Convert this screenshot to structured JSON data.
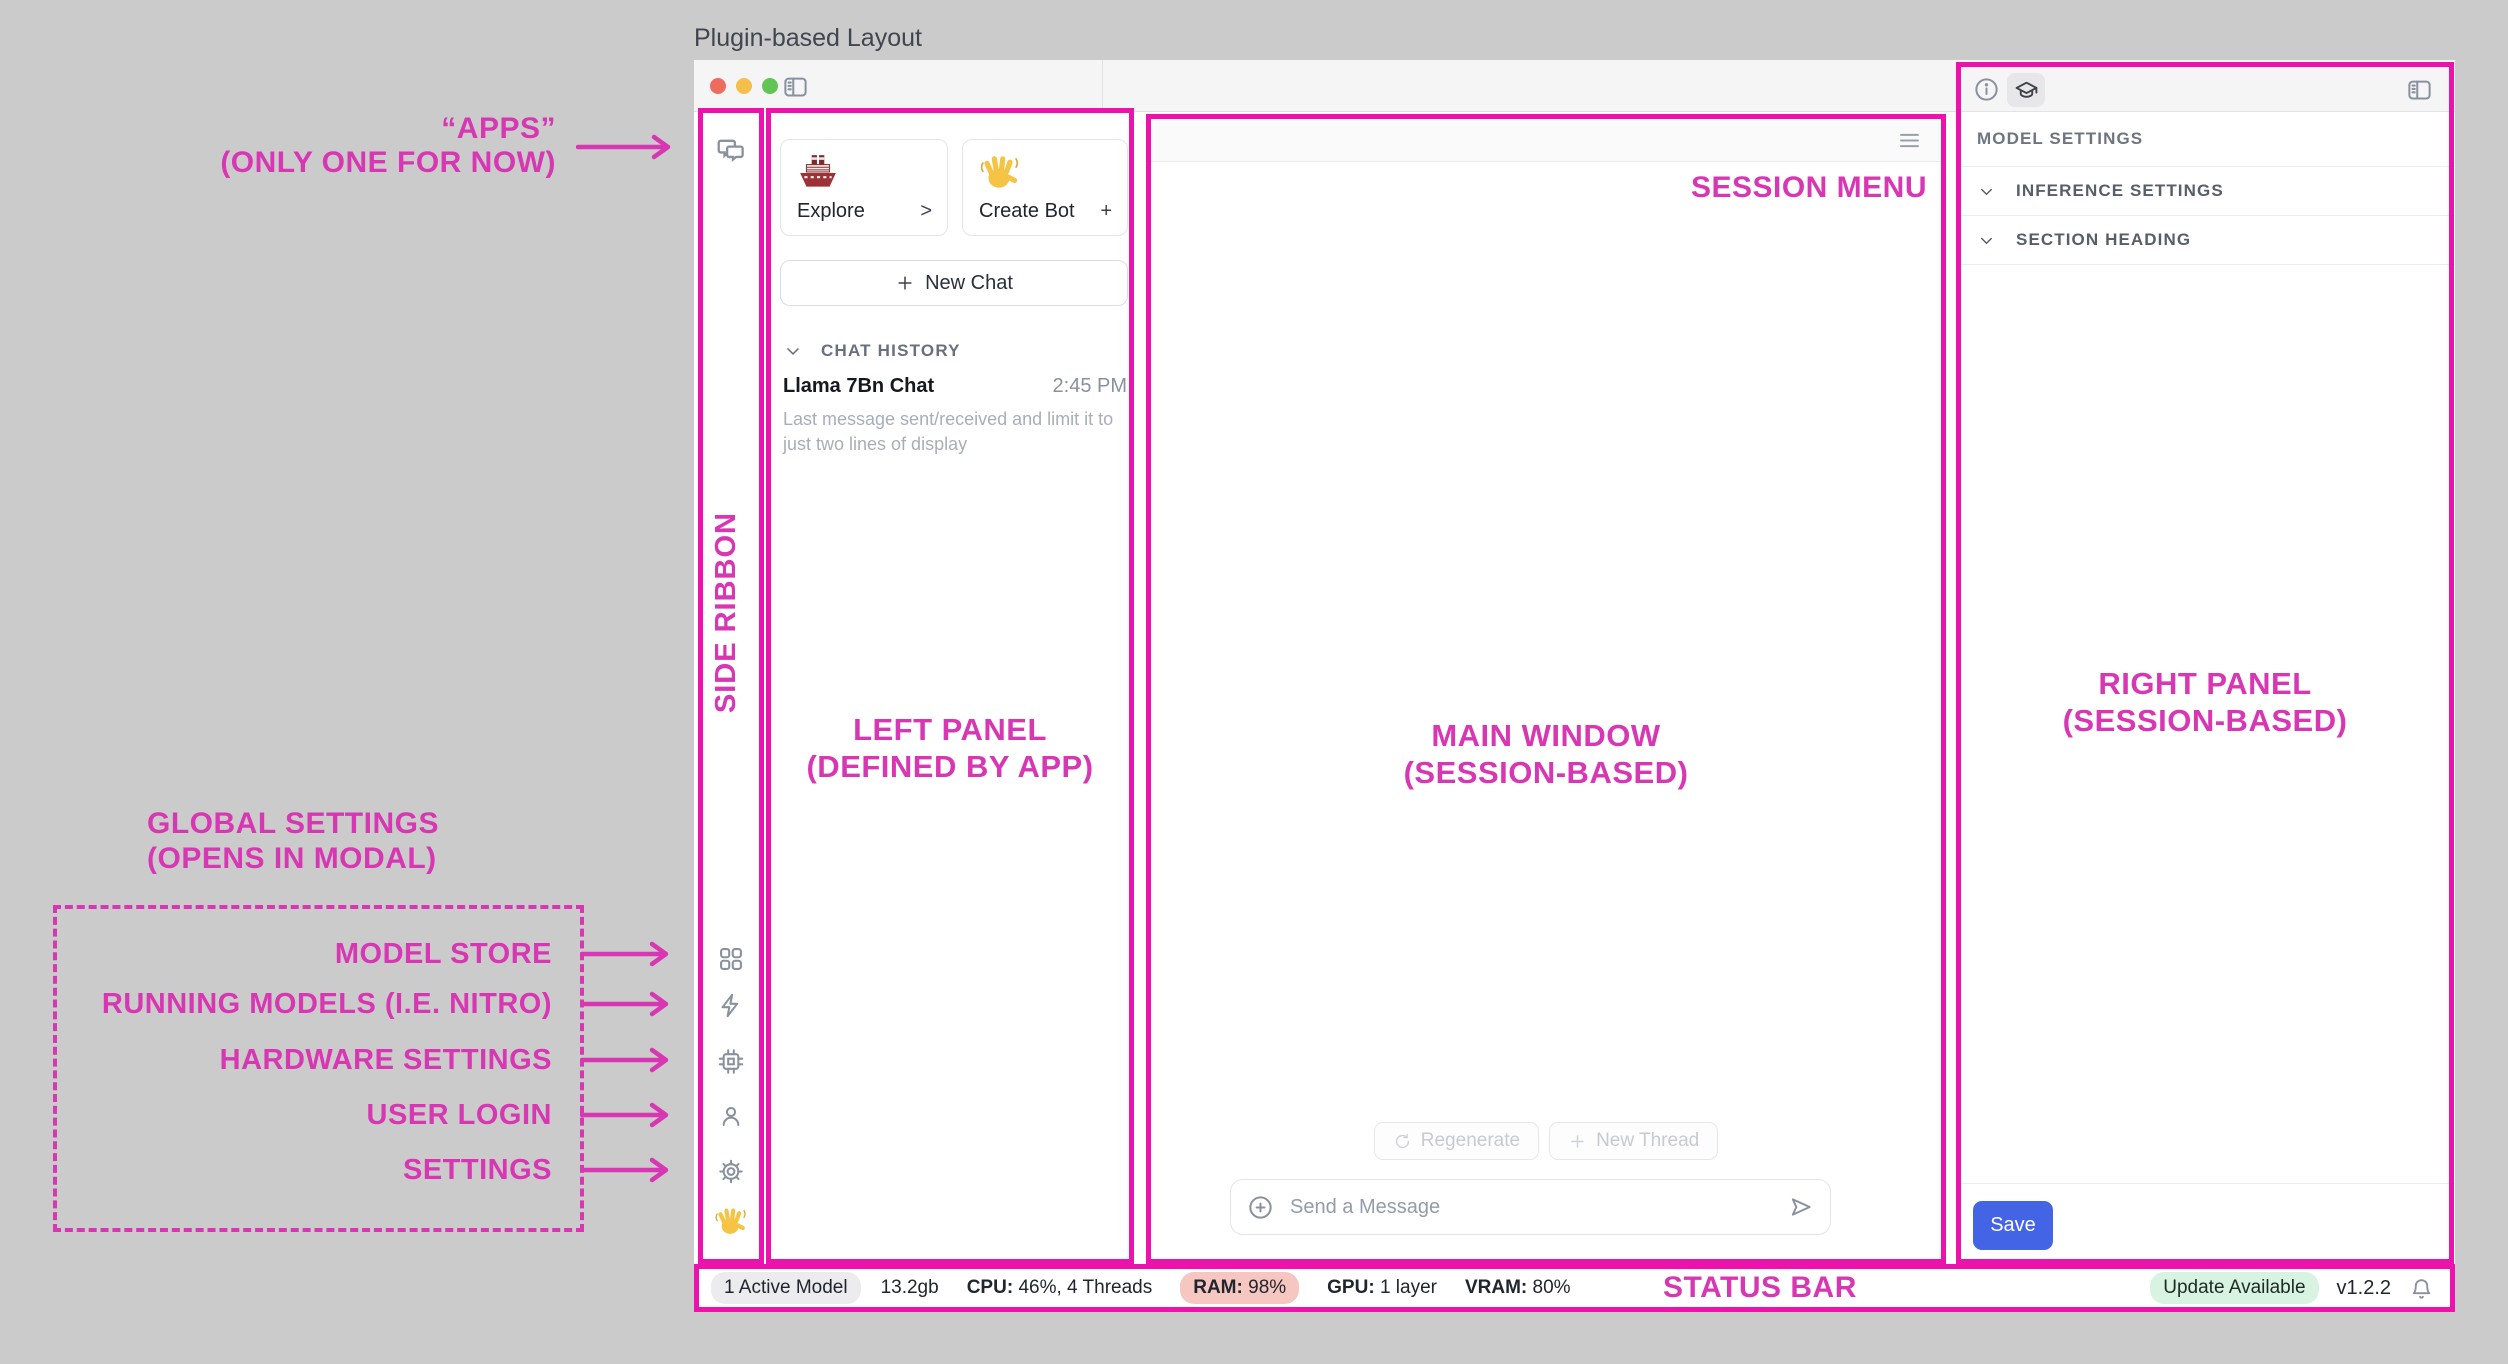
{
  "title": "Plugin-based Layout",
  "annotations": {
    "apps1": "“APPS”",
    "apps2": "(ONLY ONE FOR NOW)",
    "side_ribbon": "SIDE RIBBON",
    "left1": "LEFT PANEL",
    "left2": "(DEFINED BY APP)",
    "main1": "MAIN WINDOW",
    "main2": "(SESSION-BASED)",
    "right1": "RIGHT PANEL",
    "right2": "(SESSION-BASED)",
    "session_menu": "SESSION MENU",
    "status_bar": "STATUS BAR",
    "global1": "GLOBAL SETTINGS",
    "global2": "(OPENS IN MODAL)",
    "targets": [
      "MODEL STORE",
      "RUNNING MODELS (I.E. NITRO)",
      "HARDWARE SETTINGS",
      "USER LOGIN",
      "SETTINGS"
    ],
    "pink_text": "#d837b3",
    "pink_border": "#ec12ad"
  },
  "left_panel": {
    "explore": {
      "label": "Explore",
      "affordance": ">"
    },
    "create_bot": {
      "label": "Create Bot",
      "affordance": "+"
    },
    "new_chat": "New Chat",
    "history_header": "CHAT HISTORY",
    "chat": {
      "title": "Llama 7Bn Chat",
      "time": "2:45 PM",
      "preview": "Last message sent/received and limit it to just two lines of display"
    }
  },
  "main": {
    "regenerate": "Regenerate",
    "new_thread": "New Thread",
    "placeholder": "Send a Message"
  },
  "right_panel": {
    "header": "MODEL SETTINGS",
    "sections": [
      "INFERENCE SETTINGS",
      "SECTION HEADING"
    ],
    "save": "Save",
    "save_color": "#4364e4"
  },
  "status": {
    "active": "1 Active Model",
    "size": "13.2gb",
    "cpu_l": "CPU:",
    "cpu_v": "46%, 4 Threads",
    "ram_l": "RAM:",
    "ram_v": "98%",
    "gpu_l": "GPU:",
    "gpu_v": "1 layer",
    "vram_l": "VRAM:",
    "vram_v": "80%",
    "update": "Update Available",
    "version": "v1.2.2"
  }
}
